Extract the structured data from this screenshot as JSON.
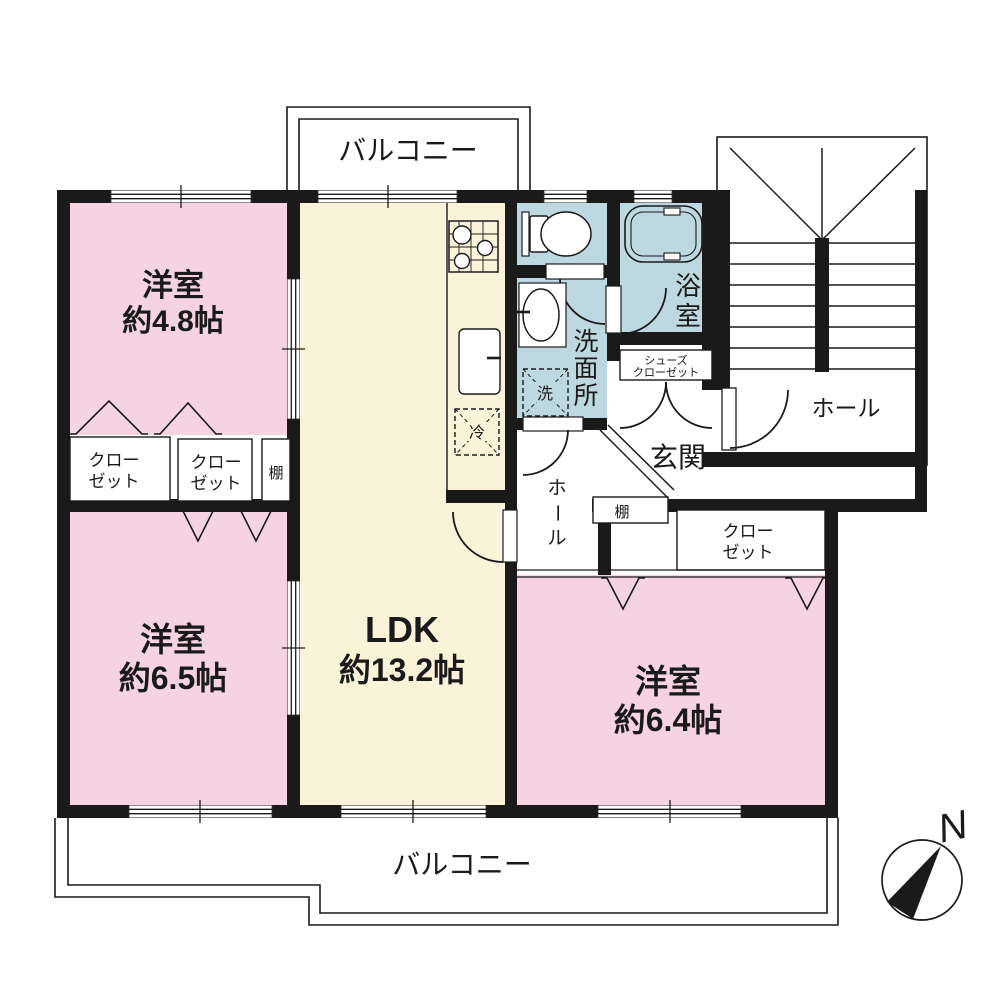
{
  "rooms": {
    "yoshitsu_48": {
      "name": "洋室",
      "size": "約4.8帖"
    },
    "yoshitsu_65": {
      "name": "洋室",
      "size": "約6.5帖"
    },
    "yoshitsu_64": {
      "name": "洋室",
      "size": "約6.4帖"
    },
    "ldk": {
      "name": "LDK",
      "size": "約13.2帖"
    },
    "bath": {
      "chars": [
        "浴",
        "室"
      ]
    },
    "washroom": {
      "chars": [
        "洗",
        "面",
        "所"
      ]
    },
    "entrance": {
      "name": "玄関"
    },
    "hall_inner": {
      "chars": [
        "ホ",
        "ー",
        "ル"
      ]
    },
    "hall_stairs": {
      "name": "ホール"
    },
    "balcony_north": {
      "name": "バルコニー"
    },
    "balcony_south": {
      "name": "バルコニー"
    }
  },
  "storage": {
    "closet_a": {
      "line1": "クロー",
      "line2": "ゼット"
    },
    "closet_b": {
      "line1": "クロー",
      "line2": "ゼット"
    },
    "closet_c": {
      "line1": "クロー",
      "line2": "ゼット"
    },
    "shoes_closet": {
      "line1": "シューズ",
      "line2": "クローゼット"
    },
    "shelf_a": {
      "name": "棚"
    },
    "shelf_b": {
      "name": "棚"
    }
  },
  "appliances": {
    "refrigerator": "冷",
    "washing_machine": "洗"
  },
  "compass": {
    "north": "N"
  },
  "colors": {
    "wall": "#1a1a1a",
    "room_pink": "#f5d3e2",
    "ldk_cream": "#faf2d9",
    "wet_area_blue": "#bdd8e1",
    "line": "#1a1a1a"
  }
}
